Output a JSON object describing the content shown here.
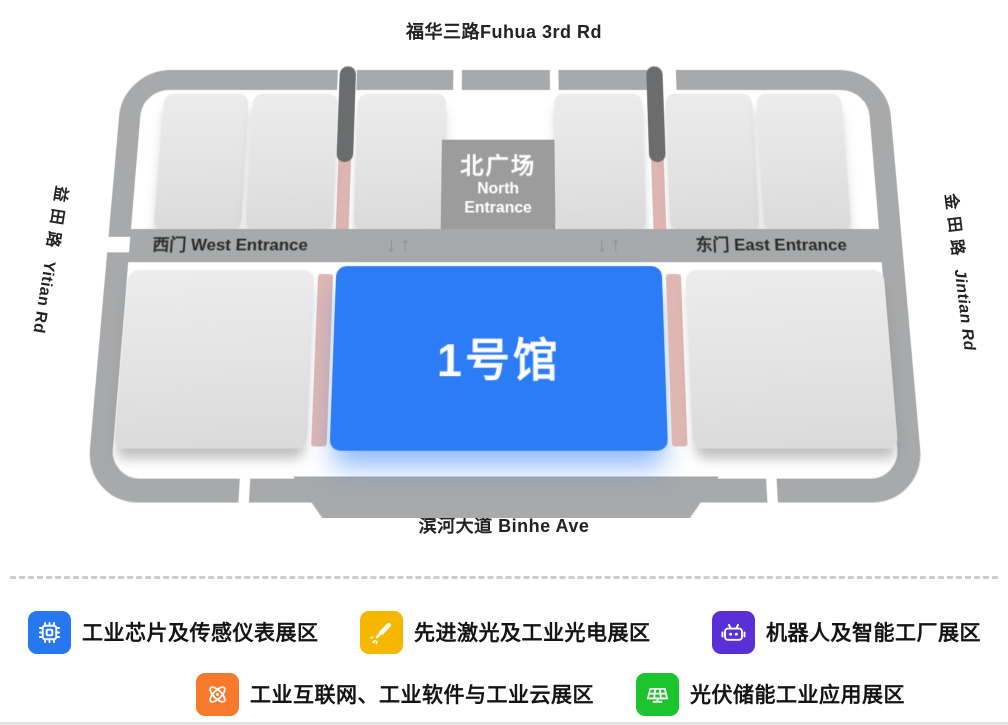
{
  "map": {
    "north_road": "福华三路Fuhua 3rd Rd",
    "south_road": "滨河大道 Binhe Ave",
    "west_road": {
      "zh": "益田路",
      "en": "Yitian Rd"
    },
    "east_road": {
      "zh": "金田路",
      "en": "Jintian Rd"
    },
    "north_plaza": {
      "zh": "北广场",
      "en1": "North",
      "en2": "Entrance"
    },
    "west_entrance": "西门 West Entrance",
    "east_entrance": "东门 East Entrance",
    "gate_arrows": "↓↑",
    "hall1_label": "1号馆",
    "colors": {
      "hall1_blue": "#2b7cf5",
      "road_gray": "#a7a9aa",
      "hall_gray": "#e2e2e3",
      "plaza_gray": "#9c9c9c",
      "corridor_pink": "#dfb7b2",
      "corridor_dark": "#6b6d6e"
    }
  },
  "legend": {
    "items": [
      {
        "icon": "chip-icon",
        "color": "#2778f0",
        "label": "工业芯片及传感仪表展区"
      },
      {
        "icon": "laser-icon",
        "color": "#f7b600",
        "label": "先进激光及工业光电展区"
      },
      {
        "icon": "robot-icon",
        "color": "#5930d8",
        "label": "机器人及智能工厂展区"
      },
      {
        "icon": "industrial-internet-icon",
        "color": "#f8792b",
        "label": "工业互联网、工业软件与工业云展区"
      },
      {
        "icon": "solar-panel-icon",
        "color": "#1cc42d",
        "label": "光伏储能工业应用展区"
      }
    ]
  }
}
